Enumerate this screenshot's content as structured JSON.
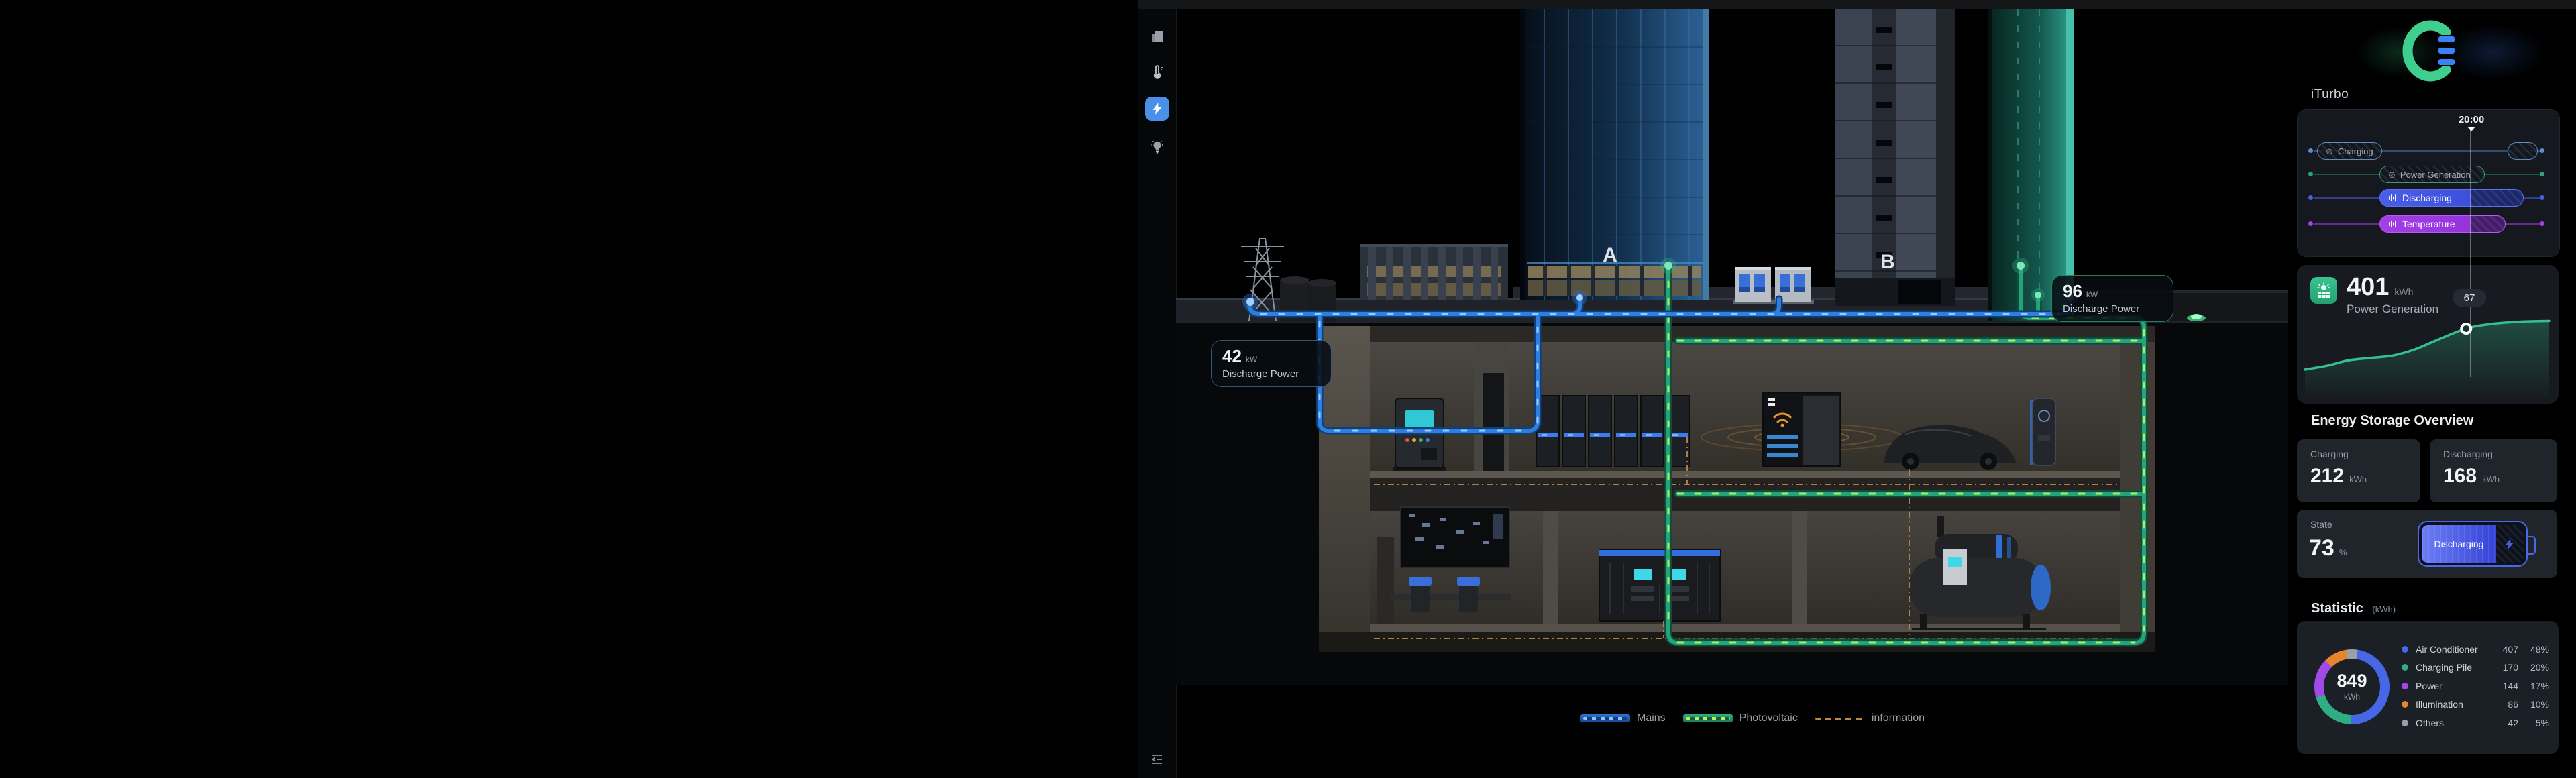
{
  "sidebar": {
    "icons": [
      {
        "name": "buildings"
      },
      {
        "name": "thermometer"
      },
      {
        "name": "energy-bolt",
        "active": true,
        "active_color": "#4a8fe8"
      },
      {
        "name": "light-bulb"
      }
    ],
    "collapse_icon": {
      "name": "collapse-menu"
    }
  },
  "scene": {
    "building_a_label": "A",
    "building_b_label": "B",
    "tooltips": [
      {
        "value": "42",
        "unit": "kW",
        "label": "Discharge Power"
      },
      {
        "value": "96",
        "unit": "kW",
        "label": "Discharge Power"
      }
    ],
    "legend": [
      {
        "label": "Mains",
        "color": "#2e6fd0"
      },
      {
        "label": "Photovoltaic",
        "color": "#2fae84"
      },
      {
        "label": "information",
        "color": "#c08a44"
      }
    ]
  },
  "panel": {
    "brand": "iTurbo",
    "timeline": {
      "time": "20:00",
      "rows": [
        {
          "label": "Charging",
          "color": "#5a8fd0",
          "state": "disabled"
        },
        {
          "label": "Power Generation",
          "color": "#2f9f7f",
          "state": "disabled"
        },
        {
          "label": "Discharging",
          "color": "#4a5fe8",
          "state": "active"
        },
        {
          "label": "Temperature",
          "color": "#a53fe8",
          "state": "active"
        }
      ]
    },
    "power_generation": {
      "value": "401",
      "unit": "kWh",
      "label": "Power Generation",
      "marker_value": "67"
    },
    "storage": {
      "title": "Energy Storage Overview",
      "charging_label": "Charging",
      "charging_value": "212",
      "charging_unit": "kWh",
      "discharging_label": "Discharging",
      "discharging_value": "168",
      "discharging_unit": "kWh",
      "state_label": "State",
      "state_value": "73",
      "state_unit": "%",
      "battery_status": "Discharging"
    },
    "statistic": {
      "title": "Statistic",
      "unit": "(kWh)",
      "total": "849",
      "total_unit": "kWh",
      "legend": [
        {
          "label": "Air Conditioner",
          "value": "407",
          "pct": "48%",
          "color": "#4667e6"
        },
        {
          "label": "Charging Pile",
          "value": "170",
          "pct": "20%",
          "color": "#2fae84"
        },
        {
          "label": "Power",
          "value": "144",
          "pct": "17%",
          "color": "#a04ae8"
        },
        {
          "label": "Illumination",
          "value": "86",
          "pct": "10%",
          "color": "#e8842b"
        },
        {
          "label": "Others",
          "value": "42",
          "pct": "5%",
          "color": "#9aa0a8"
        }
      ]
    }
  },
  "chart_data": [
    {
      "type": "area",
      "title": "Power Generation cumulative (kWh)",
      "x_percent": [
        0,
        9,
        18,
        27,
        36,
        45,
        54,
        66,
        76,
        88,
        100
      ],
      "values": [
        14,
        19,
        26,
        29,
        32,
        40,
        52,
        67,
        73,
        76,
        77
      ],
      "marker": {
        "x_percent": 66,
        "value": 67,
        "time": "20:00"
      },
      "total": 401,
      "unit": "kWh",
      "grid": false,
      "legend_position": "none",
      "line_color": "#35c08e"
    },
    {
      "type": "pie",
      "title": "Statistic (kWh)",
      "categories": [
        "Air Conditioner",
        "Charging Pile",
        "Power",
        "Illumination",
        "Others"
      ],
      "values": [
        407,
        170,
        144,
        86,
        42
      ],
      "percents": [
        48,
        20,
        17,
        10,
        5
      ],
      "total": 849,
      "unit": "kWh",
      "colors": [
        "#4667e6",
        "#2fae84",
        "#a04ae8",
        "#e8842b",
        "#9aa0a8"
      ],
      "clockwise_from_top_order": [
        "Others",
        "Air Conditioner",
        "Charging Pile",
        "Power",
        "Illumination"
      ]
    }
  ]
}
